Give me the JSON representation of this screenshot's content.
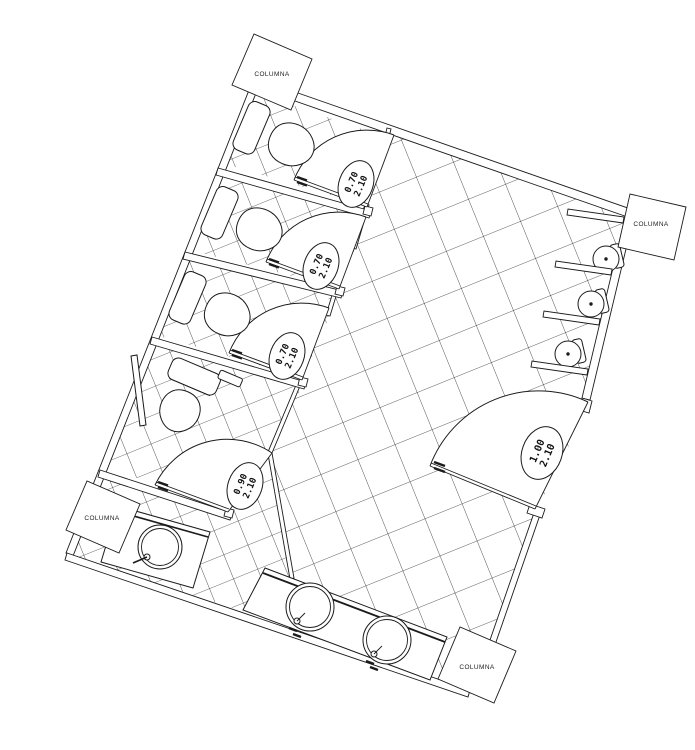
{
  "plan": {
    "columns": [
      "COLUMNA",
      "COLUMNA",
      "COLUMNA",
      "COLUMNA"
    ],
    "doors": [
      {
        "width": "0.70",
        "height": "2.10"
      },
      {
        "width": "0.70",
        "height": "2.10"
      },
      {
        "width": "0.70",
        "height": "2.10"
      },
      {
        "width": "0.90",
        "height": "2.10"
      },
      {
        "width": "1.00",
        "height": "2.10"
      }
    ]
  }
}
